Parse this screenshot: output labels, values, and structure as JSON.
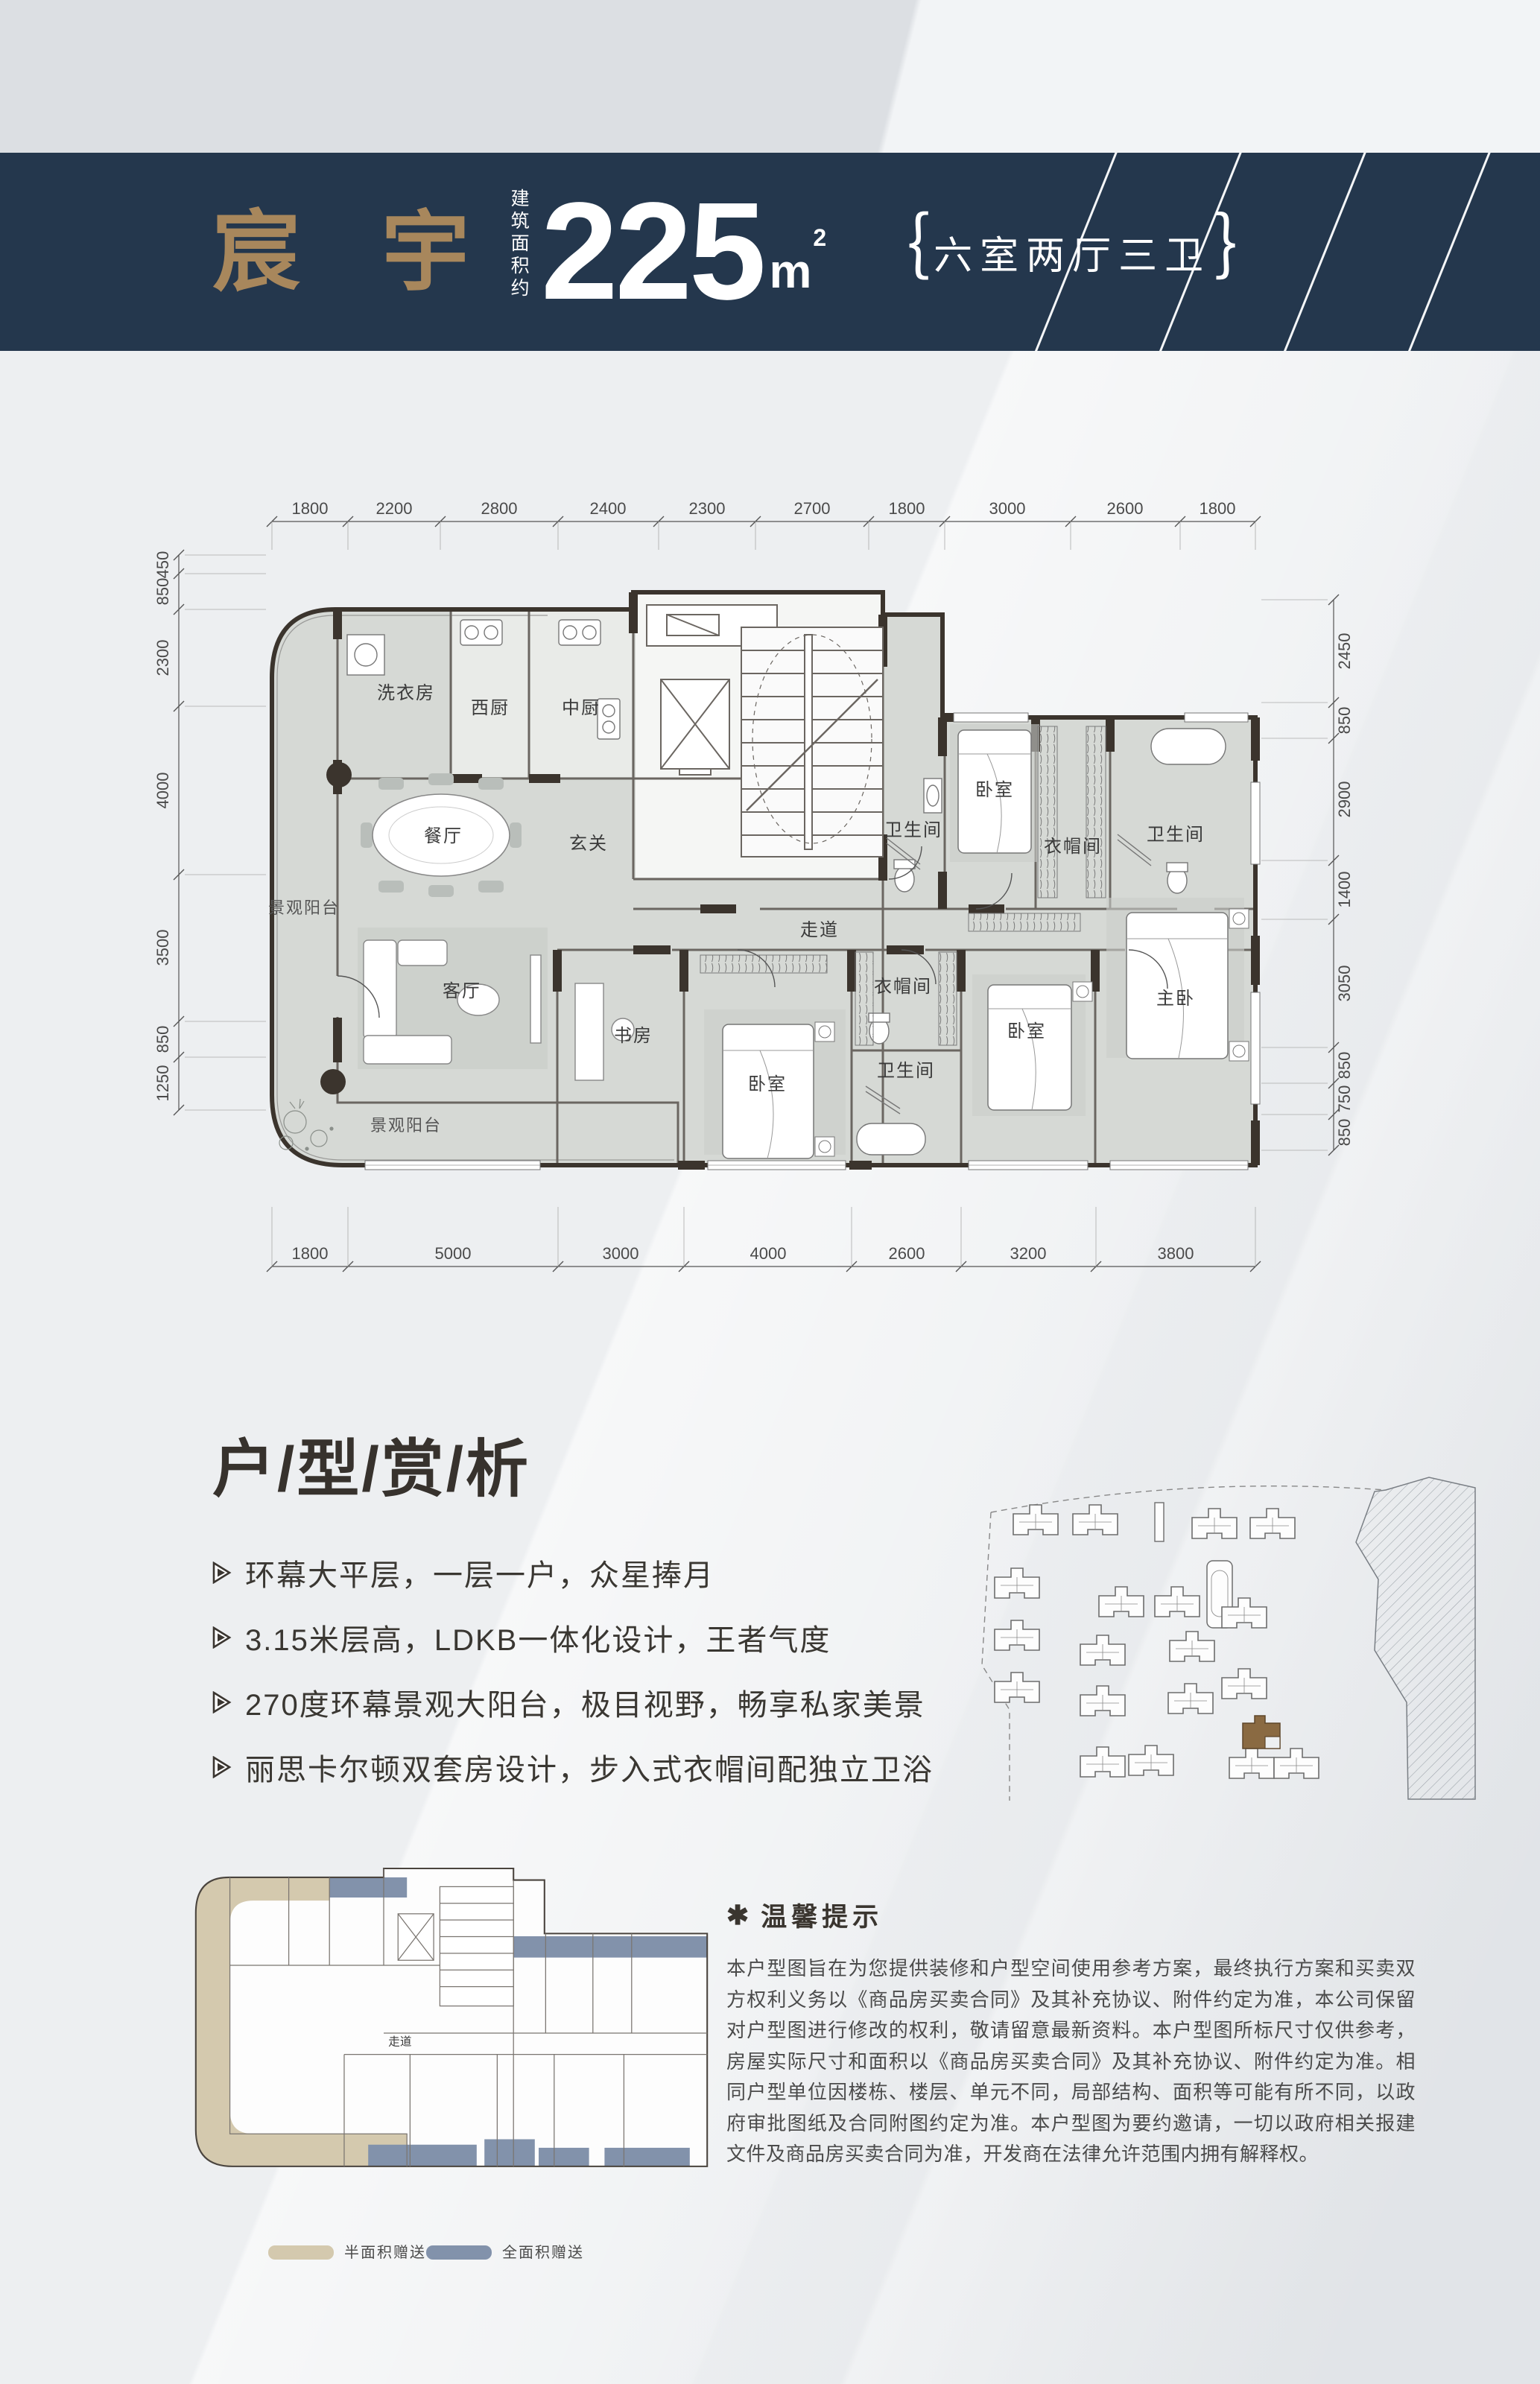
{
  "header": {
    "project_name": "宸 宇",
    "area_label_vertical": "建筑面积约",
    "area_value": "225",
    "area_unit": "m",
    "area_exponent": "2",
    "bracket_open": "｛",
    "bracket_close": "｝",
    "layout_spec": "六室两厅三卫"
  },
  "floor_plan": {
    "dims_top": [
      "1800",
      "2200",
      "2800",
      "2400",
      "2300",
      "2700",
      "1800",
      "3000",
      "2600",
      "1800"
    ],
    "dims_bottom": [
      "1800",
      "5000",
      "3000",
      "4000",
      "2600",
      "3200",
      "3800"
    ],
    "dims_left": [
      "450",
      "850",
      "2300",
      "4000",
      "3500",
      "850",
      "1250"
    ],
    "dims_right": [
      "2450",
      "850",
      "2900",
      "1400",
      "3050",
      "850",
      "750",
      "850"
    ],
    "rooms": {
      "laundry": "洗衣房",
      "west_kitchen": "西厨",
      "chinese_kitchen": "中厨",
      "dining": "餐厅",
      "foyer": "玄关",
      "corridor": "走道",
      "living": "客厅",
      "study": "书房",
      "bedroom": "卧室",
      "master_bedroom": "主卧",
      "bathroom": "卫生间",
      "cloakroom": "衣帽间",
      "view_balcony": "景观阳台"
    }
  },
  "analysis": {
    "title": "户/型/赏/析",
    "bullets": [
      "环幕大平层，一层一户，众星捧月",
      "3.15米层高，LDKB一体化设计，王者气度",
      "270度环幕景观大阳台，极目视野，畅享私家美景",
      "丽思卡尔顿双套房设计，步入式衣帽间配独立卫浴"
    ]
  },
  "notice": {
    "icon": "✱",
    "title": "温馨提示",
    "body": "本户型图旨在为您提供装修和户型空间使用参考方案，最终执行方案和买卖双方权利义务以《商品房买卖合同》及其补充协议、附件约定为准，本公司保留对户型图进行修改的权利，敬请留意最新资料。本户型图所标尺寸仅供参考，房屋实际尺寸和面积以《商品房买卖合同》及其补充协议、附件约定为准。相同户型单位因楼栋、楼层、单元不同，局部结构、面积等可能有所不同，以政府审批图纸及合同附图约定为准。本户型图为要约邀请，一切以政府相关报建文件及商品房买卖合同为准，开发商在法律允许范围内拥有解释权。"
  },
  "legend": {
    "items": [
      {
        "label": "半面积赠送",
        "color": "#d4c9ae"
      },
      {
        "label": "全面积赠送",
        "color": "#8292ab"
      }
    ]
  },
  "colors": {
    "header_band": "#24374d",
    "brand_gold": "#a8875c",
    "wall_dark": "#3b342d",
    "room_fill": "#d6d9d5",
    "gift_half": "#d4c9ae",
    "gift_full": "#8292ab"
  }
}
